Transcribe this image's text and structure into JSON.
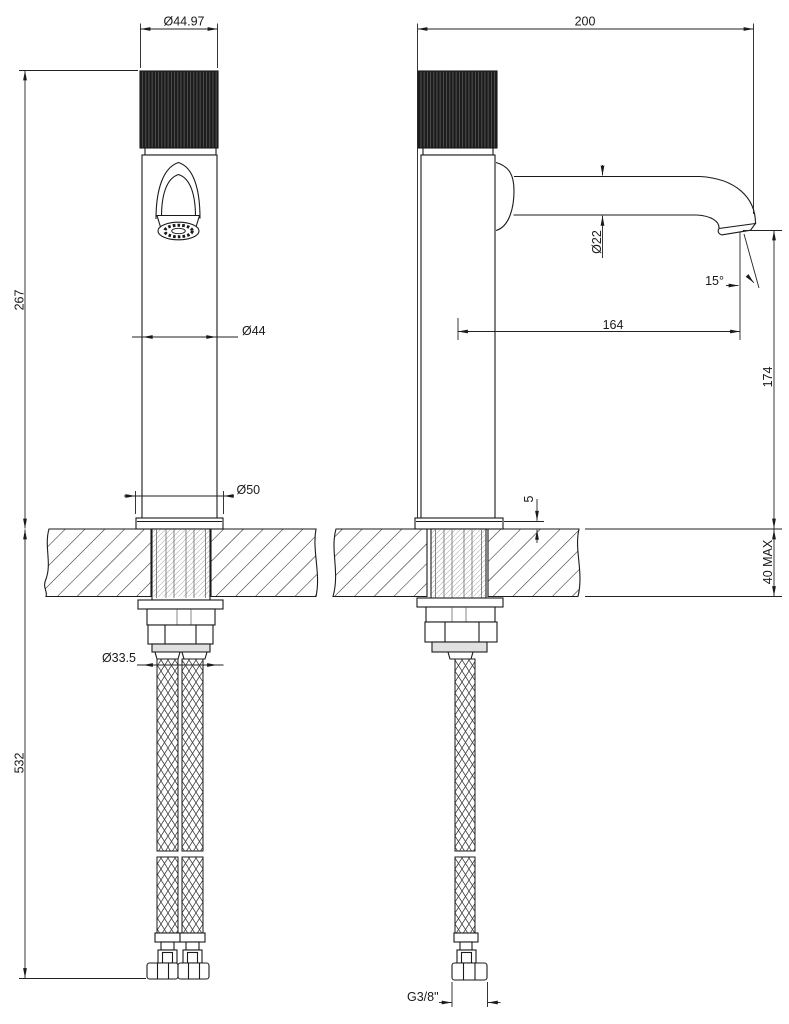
{
  "drawing": {
    "background": "#ffffff",
    "line_color": "#1a1a1a",
    "views": [
      "front view",
      "side view"
    ]
  },
  "dimensions": {
    "handle_diameter": "Ø44.97",
    "overall_depth": "200",
    "height_above_deck": "267",
    "body_diameter": "Ø44",
    "spout_tube_diameter": "Ø22",
    "outlet_angle": "15°",
    "spout_reach": "164",
    "outlet_height": "174",
    "base_diameter": "Ø50",
    "base_plate_height": "5",
    "max_deck_thickness": "40 MAX",
    "shank_diameter": "Ø33.5",
    "hose_drop_length": "532",
    "supply_connection": "G3/8\""
  }
}
